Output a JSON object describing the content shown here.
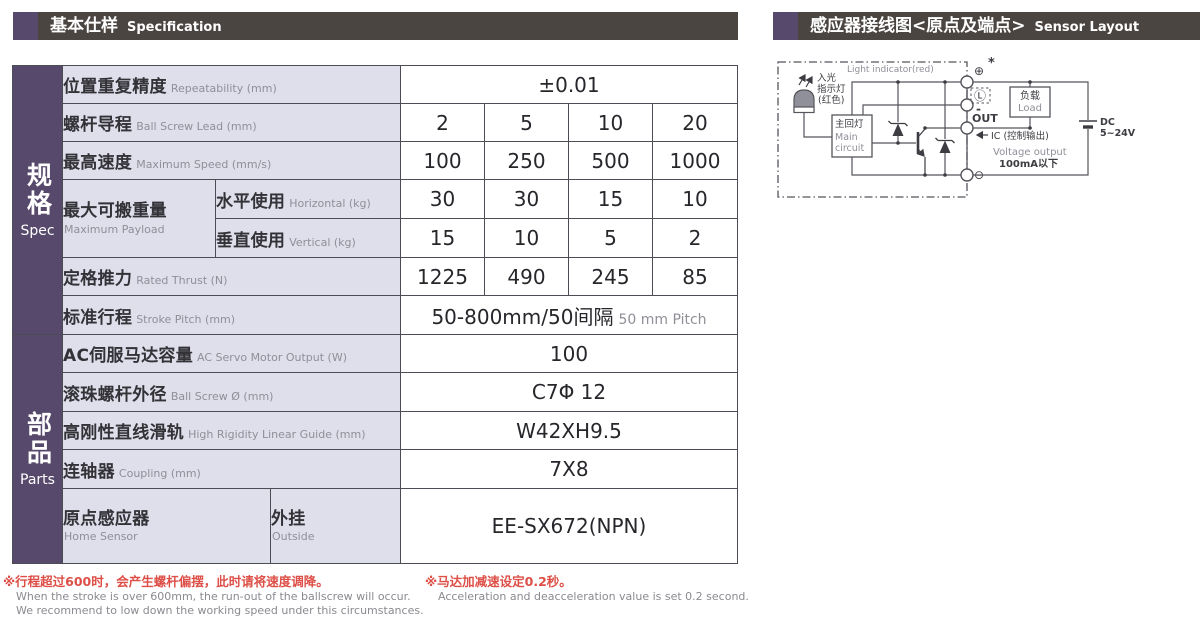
{
  "colors": {
    "purple": "#57496b",
    "header_bar": "#4b4542",
    "label_bg": "#dfdeeb",
    "table_border": "#4c4c54",
    "note_red": "#dd4f47",
    "muted_gray": "#8f8f98"
  },
  "header_left": {
    "title_zh": "基本仕样",
    "title_en": "Specification"
  },
  "header_right": {
    "title_zh": "感应器接线图<原点及端点>",
    "title_en": "Sensor Layout"
  },
  "sidebar": {
    "spec_zh": "规格",
    "spec_en": "Spec",
    "parts_zh": "部品",
    "parts_en": "Parts"
  },
  "spec_table": {
    "repeatability": {
      "zh": "位置重复精度",
      "en": "Repeatability (mm)",
      "value": "±0.01"
    },
    "lead": {
      "zh": "螺杆导程",
      "en": "Ball Screw Lead (mm)",
      "values": [
        "2",
        "5",
        "10",
        "20"
      ]
    },
    "speed": {
      "zh": "最高速度",
      "en": "Maximum Speed (mm/s)",
      "values": [
        "100",
        "250",
        "500",
        "1000"
      ]
    },
    "payload": {
      "zh": "最大可搬重量",
      "en": "Maximum Payload"
    },
    "horizontal": {
      "zh": "水平使用",
      "en": "Horizontal (kg)",
      "values": [
        "30",
        "30",
        "15",
        "10"
      ]
    },
    "vertical": {
      "zh": "垂直使用",
      "en": "Vertical (kg)",
      "values": [
        "15",
        "10",
        "5",
        "2"
      ]
    },
    "thrust": {
      "zh": "定格推力",
      "en": "Rated Thrust (N)",
      "values": [
        "1225",
        "490",
        "245",
        "85"
      ]
    },
    "stroke": {
      "zh": "标准行程",
      "en": "Stroke Pitch (mm)",
      "value": "50-800mm/50间隔",
      "value_note": "50 mm Pitch"
    },
    "servo": {
      "zh": "AC伺服马达容量",
      "en": "AC Servo Motor Output (W)",
      "value": "100"
    },
    "screw_od": {
      "zh": "滚珠螺杆外径",
      "en": "Ball Screw Ø (mm)",
      "value": "C7Φ 12"
    },
    "guide": {
      "zh": "高刚性直线滑轨",
      "en": "High Rigidity Linear Guide (mm)",
      "value": "W42XH9.5"
    },
    "coupling": {
      "zh": "连轴器",
      "en": "Coupling (mm)",
      "value": "7X8"
    },
    "home_sensor": {
      "zh": "原点感应器",
      "en": "Home Sensor",
      "mount_zh": "外挂",
      "mount_en": "Outside",
      "value": "EE-SX672(NPN)"
    }
  },
  "diagram": {
    "light_indicator_en": "Light indicator(red)",
    "light_zh1": "入光",
    "light_zh2": "指示灯",
    "light_zh3": "(红色)",
    "main_circuit_zh": "主回灯",
    "main_circuit_en1": "Main",
    "main_circuit_en2": "circuit",
    "terminal_plus": "⊕",
    "star": "*",
    "terminal_light": "Ⓛ",
    "minus_mark": "-",
    "terminal_out": "OUT",
    "terminal_minus": "⊖",
    "ic_label": "IC (控制输出)",
    "voltage_output": "Voltage output",
    "current_note": "100mA以下",
    "load_zh": "负载",
    "load_en": "Load",
    "dc": "DC",
    "dc_range": "5~24V"
  },
  "footnotes": {
    "left_zh": "※行程超过600时，会产生螺杆偏摆，此时请将速度调降。",
    "left_en1": "When the stroke is over 600mm, the run-out of the ballscrew will occur.",
    "left_en2": "We recommend to low down the working speed under this circumstances.",
    "right_zh": "※马达加减速设定0.2秒。",
    "right_en": "Acceleration and deacceleration value is set 0.2 second."
  }
}
